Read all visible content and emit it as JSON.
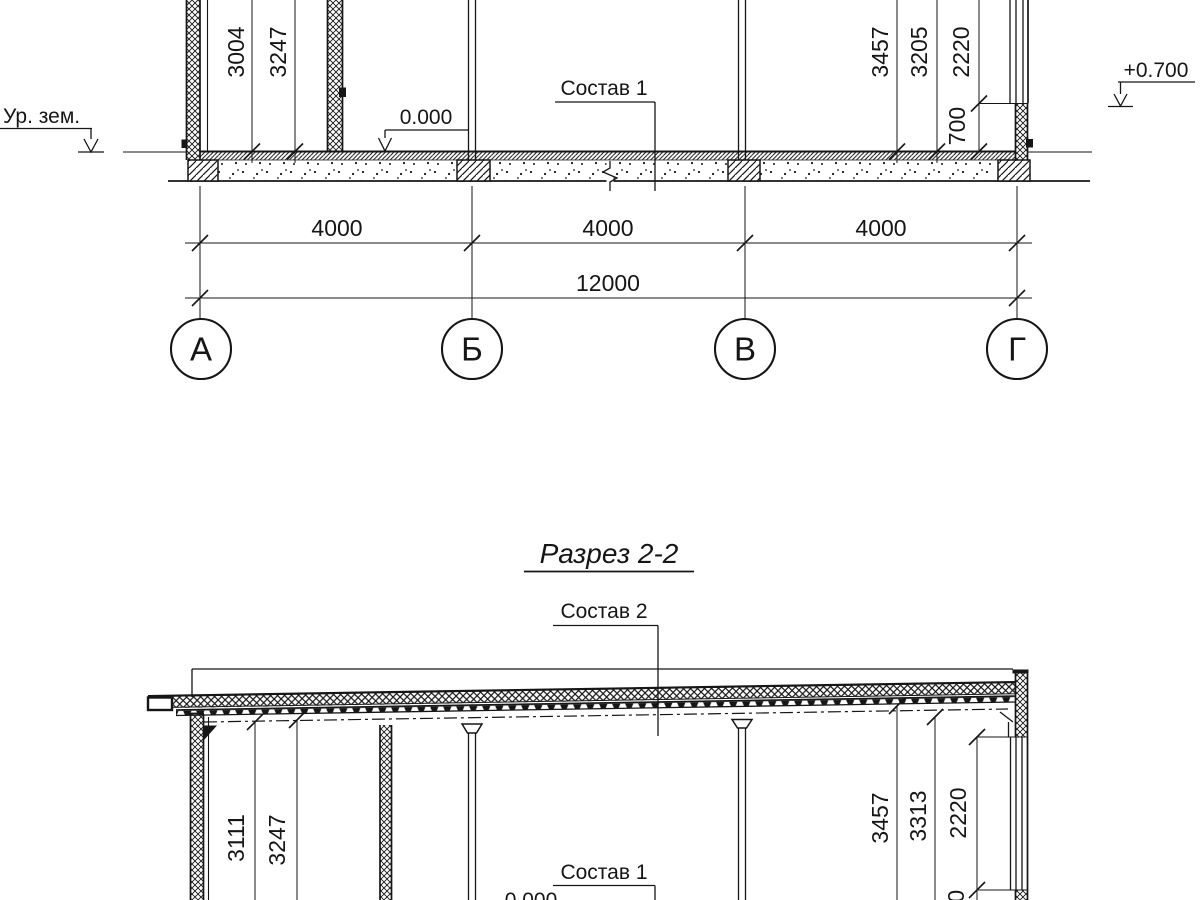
{
  "colors": {
    "ink": "#161616",
    "paper": "#ffffff"
  },
  "section_1": {
    "ground_label": "Ур. зем.",
    "zero_mark": "0.000",
    "plus_mark": "+0.700",
    "floor_callout": "Состав 1",
    "dims_left": [
      "3004",
      "3247"
    ],
    "dims_right": [
      "3457",
      "3205",
      "2220"
    ],
    "sill_dim": "700",
    "span_dims": [
      "4000",
      "4000",
      "4000"
    ],
    "total_dim": "12000",
    "axes": [
      "А",
      "Б",
      "В",
      "Г"
    ]
  },
  "section_2": {
    "title": "Разрез 2-2",
    "roof_callout": "Состав 2",
    "floor_callout": "Состав 1",
    "zero_mark": "0.000",
    "dims_left": [
      "3111",
      "3247"
    ],
    "dims_right": [
      "3457",
      "3313",
      "2220"
    ],
    "sill_dim": "700"
  }
}
